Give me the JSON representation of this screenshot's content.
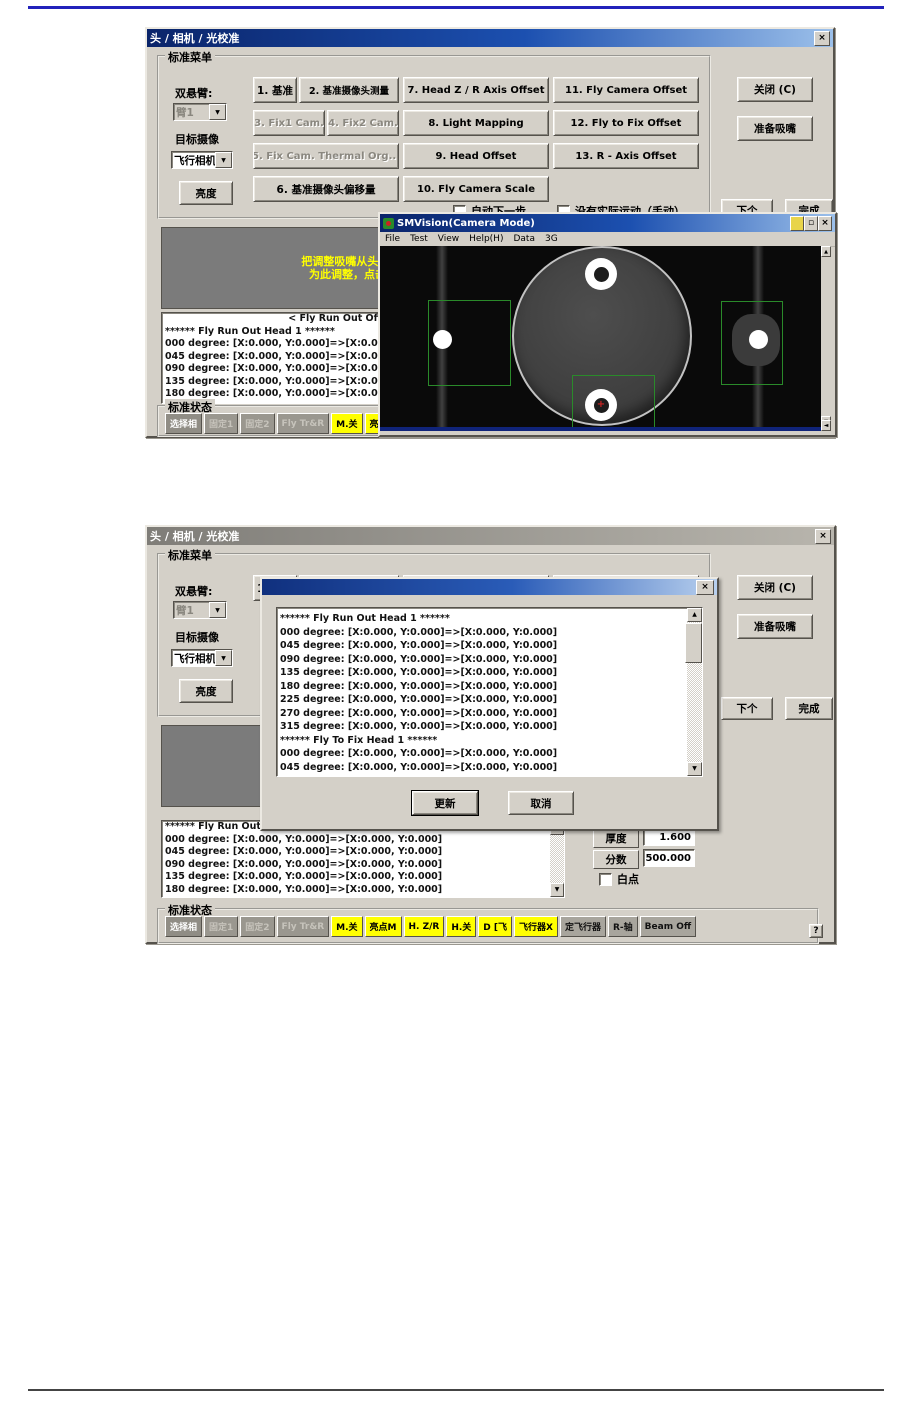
{
  "page": {
    "top_rule_color": "#2222bb",
    "bottom_rule_color": "#444444"
  },
  "shared": {
    "window_title": "头 / 相机 / 光校准",
    "close_x": "×",
    "menu_group_title": "标准菜单",
    "arm_label": "双悬臂:",
    "arm_value": "臂1",
    "target_label": "目标摄像",
    "target_value": "飞行相机1",
    "brightness_button": "亮度",
    "grid_buttons": {
      "b1": "1. 基准",
      "b2": "2. 基准摄像头测量",
      "b3": "3. Fix1 Cam.",
      "b4": "4. Fix2 Cam.",
      "b5": "5. Fix Cam. Thermal Org...",
      "b6": "6. 基准摄像头偏移量",
      "b7": "7. Head Z / R Axis Offset",
      "b8": "8. Light Mapping",
      "b9": "9. Head Offset",
      "b10": "10. Fly Camera Scale",
      "b11": "11. Fly Camera Offset",
      "b12": "12. Fly to Fix Offset",
      "b13": "13. R - Axis Offset"
    },
    "close_button": "关闭 (C)",
    "prepare_button": "准备吸嘴",
    "auto_next_checkbox": "自动下一步",
    "manual_checkbox": "没有实际运动（手动）",
    "next_button": "下个",
    "finish_button": "完成",
    "status_group_title": "标准状态",
    "status_buttons": [
      {
        "label": "选择相",
        "style": "dark"
      },
      {
        "label": "固定1",
        "style": "disabled"
      },
      {
        "label": "固定2",
        "style": "disabled"
      },
      {
        "label": "Fly Tr&R",
        "style": "disabled"
      },
      {
        "label": "M.关",
        "style": "yellow"
      },
      {
        "label": "亮点M",
        "style": "yellow"
      },
      {
        "label": "H. Z/R",
        "style": "yellow"
      },
      {
        "label": "H.关",
        "style": "yellow"
      },
      {
        "label": "D [飞",
        "style": "yellow"
      },
      {
        "label": "飞行器X",
        "style": "yellow"
      },
      {
        "label": "定飞行器",
        "style": "gray"
      },
      {
        "label": "R-轴",
        "style": "gray"
      },
      {
        "label": "Beam Off",
        "style": "gray"
      }
    ]
  },
  "dialog1": {
    "instruction_line1": "把调整吸嘴从头1",
    "instruction_line2": "为此调整，点击",
    "list_header": "< Fly Run Out Offset Data >",
    "list_lines": [
      "****** Fly Run Out Head  1 ******",
      "000 degree: [X:0.000, Y:0.000]=>[X:0.000, Y:0.000]",
      "045 degree: [X:0.000, Y:0.000]=>[X:0.000, Y:0.000]",
      "090 degree: [X:0.000, Y:0.000]=>[X:0.000, Y:0.000]",
      "135 degree: [X:0.000, Y:0.000]=>[X:0.000, Y:0.000]",
      "180 degree: [X:0.000, Y:0.000]=>[X:0.000, Y:0.000]"
    ]
  },
  "smvision": {
    "title": "SMVision(Camera Mode)",
    "menu_items": [
      "File",
      "Test",
      "View",
      "Help(H)",
      "Data",
      "3G"
    ]
  },
  "dialog2": {
    "instruction_line1": "",
    "instruction_line2": "",
    "list_lines": [
      "****** Fly Run Out Head  1 ******",
      "000 degree: [X:0.000, Y:0.000]=>[X:0.000, Y:0.000]",
      "045 degree: [X:0.000, Y:0.000]=>[X:0.000, Y:0.000]",
      "090 degree: [X:0.000, Y:0.000]=>[X:0.000, Y:0.000]",
      "135 degree: [X:0.000, Y:0.000]=>[X:0.000, Y:0.000]",
      "180 degree: [X:0.000, Y:0.000]=>[X:0.000, Y:0.000]"
    ],
    "thickness_label": "厚度",
    "thickness_value": "1.600",
    "score_label": "分数",
    "score_value": "500.000",
    "white_dot_checkbox": "白点",
    "help_button": "?"
  },
  "popup": {
    "title": "",
    "lines": [
      "****** Fly Run Out Head  1 ******",
      "000 degree: [X:0.000, Y:0.000]=>[X:0.000, Y:0.000]",
      "045 degree: [X:0.000, Y:0.000]=>[X:0.000, Y:0.000]",
      "090 degree: [X:0.000, Y:0.000]=>[X:0.000, Y:0.000]",
      "135 degree: [X:0.000, Y:0.000]=>[X:0.000, Y:0.000]",
      "180 degree: [X:0.000, Y:0.000]=>[X:0.000, Y:0.000]",
      "225 degree: [X:0.000, Y:0.000]=>[X:0.000, Y:0.000]",
      "270 degree: [X:0.000, Y:0.000]=>[X:0.000, Y:0.000]",
      "315 degree: [X:0.000, Y:0.000]=>[X:0.000, Y:0.000]",
      "****** Fly To Fix Head  1 ******",
      "000 degree: [X:0.000, Y:0.000]=>[X:0.000, Y:0.000]",
      "045 degree: [X:0.000, Y:0.000]=>[X:0.000, Y:0.000]"
    ],
    "update_button": "更新",
    "cancel_button": "取消"
  }
}
